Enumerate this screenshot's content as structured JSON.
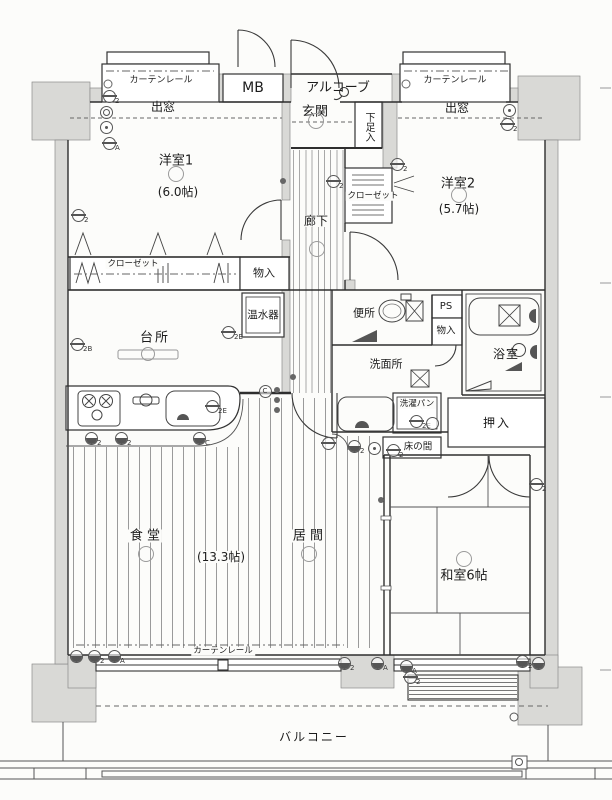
{
  "labels": {
    "curtain_left": "カーテンレール",
    "bay_left": "出窓",
    "mb": "MB",
    "alcove": "アルコーブ",
    "curtain_right": "カーテンレール",
    "bay_right": "出窓",
    "genkan": "玄関",
    "shoe_box": "下足入",
    "bedroom1": "洋室1",
    "bedroom1_size": "(6.0帖)",
    "bedroom2": "洋室2",
    "bedroom2_size": "(5.7帖)",
    "closet2": "クローゼット",
    "hallway": "廊下",
    "closet1": "クローゼット",
    "storage1": "物入",
    "water_heater": "温水器",
    "kitchen": "台所",
    "toilet": "便所",
    "ps": "PS",
    "storage2": "物入",
    "bathroom": "浴室",
    "washroom": "洗面所",
    "laundry_pan": "洗濯パン",
    "tokonoma": "床の間",
    "oshiire": "押入",
    "washitsu": "和室6帖",
    "dining": "食 堂",
    "ld_size": "(13.3帖)",
    "living": "居 間",
    "curtain_bottom": "カーテンレール",
    "balcony": "バルコニー"
  },
  "colors": {
    "wall_fill": "#d9d9d6",
    "line": "#2e2e2e",
    "page_bg": "#fcfcfa"
  },
  "symbols": [
    {
      "x": 109,
      "y": 96,
      "v": "lined",
      "t": "2"
    },
    {
      "x": 106,
      "y": 112,
      "v": "double"
    },
    {
      "x": 106,
      "y": 127,
      "v": "dot"
    },
    {
      "x": 109,
      "y": 143,
      "v": "lined",
      "t": "A"
    },
    {
      "x": 78,
      "y": 215,
      "v": "lined",
      "t": "2"
    },
    {
      "x": 397,
      "y": 164,
      "v": "lined",
      "t": "2"
    },
    {
      "x": 509,
      "y": 110,
      "v": "dot"
    },
    {
      "x": 507,
      "y": 124,
      "v": "lined",
      "t": "2"
    },
    {
      "x": 316,
      "y": 121,
      "v": "light"
    },
    {
      "x": 333,
      "y": 181,
      "v": "lined",
      "t": "2"
    },
    {
      "x": 317,
      "y": 249,
      "v": "light"
    },
    {
      "x": 176,
      "y": 174,
      "v": "light"
    },
    {
      "x": 459,
      "y": 195,
      "v": "light"
    },
    {
      "x": 228,
      "y": 332,
      "v": "lined",
      "t": "2E"
    },
    {
      "x": 77,
      "y": 344,
      "v": "lined",
      "t": "2B"
    },
    {
      "x": 212,
      "y": 406,
      "v": "lined",
      "t": "2E"
    },
    {
      "x": 91,
      "y": 438,
      "v": "half",
      "t": "2"
    },
    {
      "x": 121,
      "y": 438,
      "v": "half",
      "t": "2"
    },
    {
      "x": 199,
      "y": 438,
      "v": "half",
      "t": "C"
    },
    {
      "x": 265,
      "y": 391,
      "v": "plain",
      "l": "C"
    },
    {
      "x": 328,
      "y": 443,
      "v": "lined"
    },
    {
      "x": 354,
      "y": 446,
      "v": "half",
      "t": "2"
    },
    {
      "x": 374,
      "y": 448,
      "v": "dot"
    },
    {
      "x": 393,
      "y": 450,
      "v": "lined",
      "t": "2"
    },
    {
      "x": 536,
      "y": 484,
      "v": "lined",
      "t": "2"
    },
    {
      "x": 464,
      "y": 559,
      "v": "light"
    },
    {
      "x": 146,
      "y": 554,
      "v": "light"
    },
    {
      "x": 309,
      "y": 554,
      "v": "light"
    },
    {
      "x": 76,
      "y": 656,
      "v": "half"
    },
    {
      "x": 94,
      "y": 656,
      "v": "half",
      "t": "2"
    },
    {
      "x": 114,
      "y": 656,
      "v": "half",
      "t": "A"
    },
    {
      "x": 344,
      "y": 663,
      "v": "half",
      "t": "2"
    },
    {
      "x": 377,
      "y": 663,
      "v": "half",
      "t": "A"
    },
    {
      "x": 406,
      "y": 666,
      "v": "half",
      "t": "A"
    },
    {
      "x": 410,
      "y": 677,
      "v": "lined",
      "t": "2"
    },
    {
      "x": 522,
      "y": 661,
      "v": "half",
      "t": "2"
    },
    {
      "x": 538,
      "y": 663,
      "v": "half"
    },
    {
      "x": 416,
      "y": 421,
      "v": "lined",
      "t": "2E"
    },
    {
      "x": 432,
      "y": 423,
      "v": "plain"
    },
    {
      "x": 283,
      "y": 181,
      "v": "fill"
    },
    {
      "x": 277,
      "y": 390,
      "v": "fill"
    },
    {
      "x": 277,
      "y": 400,
      "v": "fill"
    },
    {
      "x": 277,
      "y": 410,
      "v": "fill"
    },
    {
      "x": 293,
      "y": 377,
      "v": "fill"
    },
    {
      "x": 381,
      "y": 500,
      "v": "fill"
    }
  ]
}
